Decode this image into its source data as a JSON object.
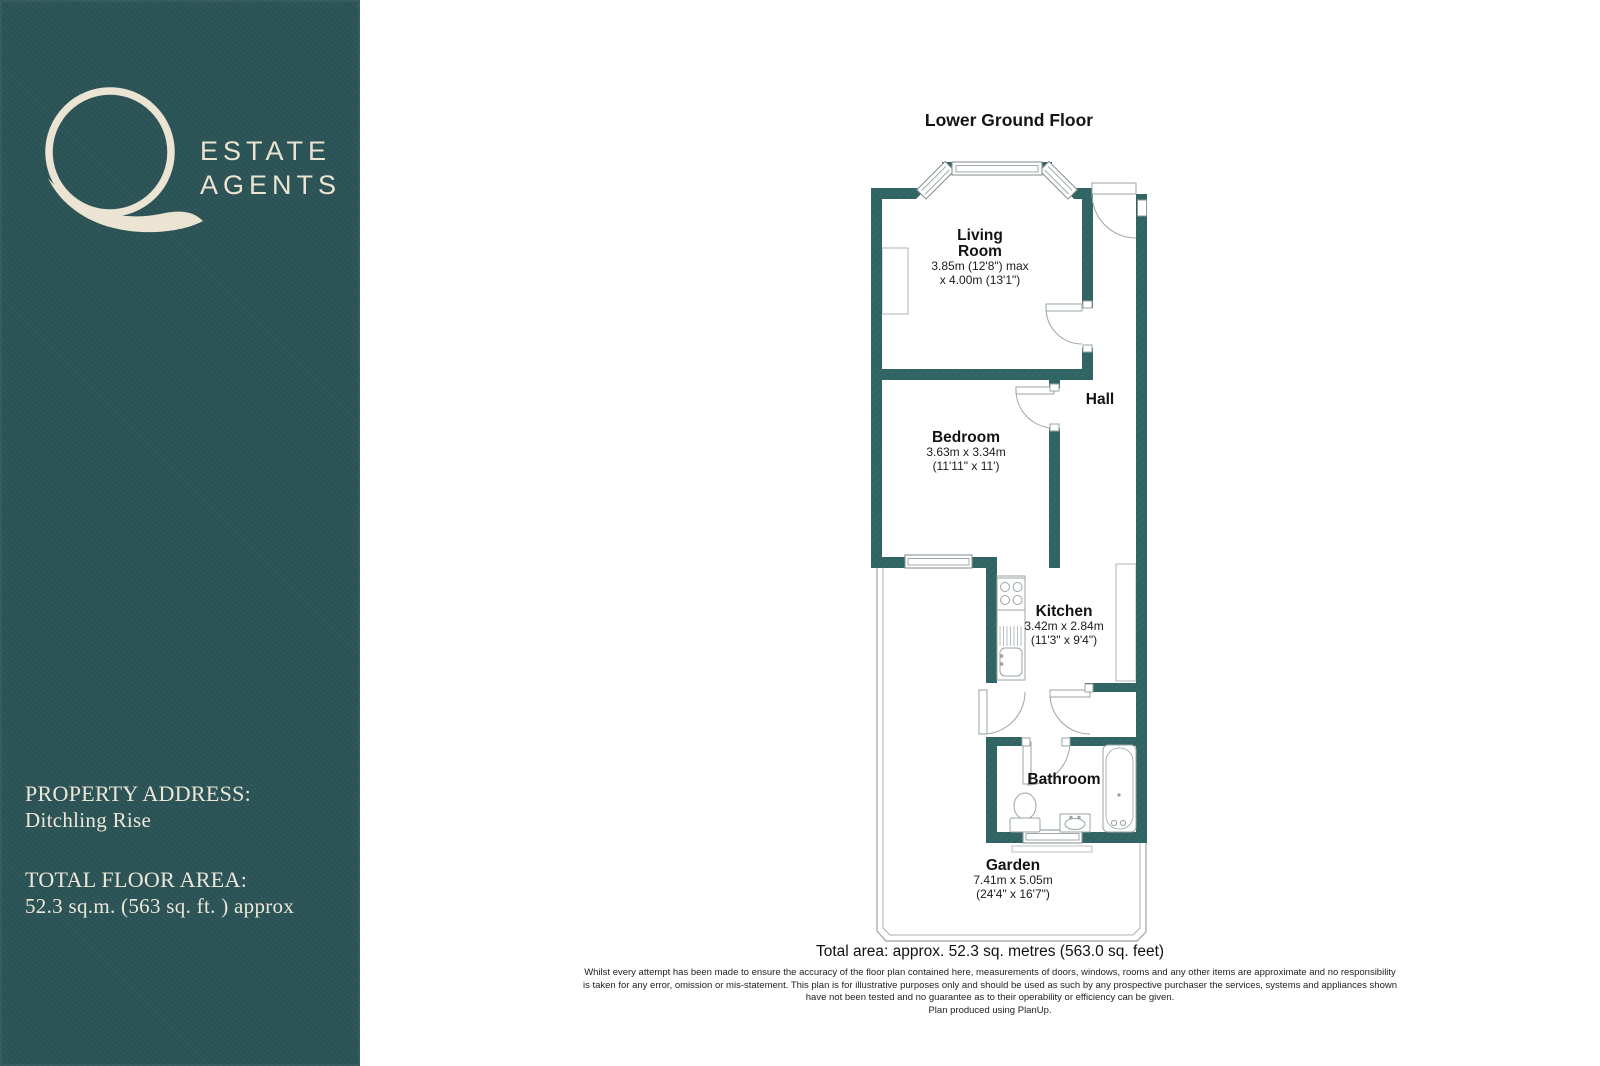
{
  "colors": {
    "sidebar_bg": "#2b5355",
    "wall_teal": "#2f6462",
    "logo_cream": "#ece4d2",
    "fixture_gray": "#9aa4a4",
    "label_black": "#131313"
  },
  "sidebar": {
    "logo": {
      "mark": "Q",
      "line1": "ESTATE",
      "line2": "AGENTS"
    },
    "property_address_label": "PROPERTY ADDRESS:",
    "property_address_value": "Ditchling Rise",
    "floor_area_label": "TOTAL FLOOR AREA:",
    "floor_area_value": "52.3 sq.m. (563 sq. ft. ) approx"
  },
  "plan": {
    "title": "Lower Ground Floor",
    "rooms": {
      "living": {
        "line1": "Living",
        "line2": "Room",
        "dim1": "3.85m (12'8\") max",
        "dim2": "x 4.00m (13'1\")"
      },
      "hall": {
        "name": "Hall"
      },
      "bedroom": {
        "name": "Bedroom",
        "dim1": "3.63m x 3.34m",
        "dim2": "(11'11\" x 11')"
      },
      "kitchen": {
        "name": "Kitchen",
        "dim1": "3.42m x 2.84m",
        "dim2": "(11'3\" x 9'4\")"
      },
      "bathroom": {
        "name": "Bathroom"
      },
      "garden": {
        "name": "Garden",
        "dim1": "7.41m x 5.05m",
        "dim2": "(24'4\" x 16'7\")"
      }
    },
    "total_area": "Total area: approx. 52.3 sq. metres (563.0 sq. feet)",
    "disclaimer": {
      "line1": "Whilst every attempt has been made to ensure the accuracy of the floor plan contained here, measurements of doors, windows, rooms and any other items are approximate and no responsibility",
      "line2": "is taken for any error, omission or mis-statement. This plan is for illustrative purposes only and should be used as such by any prospective purchaser the services, systems and appliances shown",
      "line3": "have not been tested and no guarantee as to their operability or efficiency can be given.",
      "line4": "Plan produced using PlanUp."
    }
  }
}
